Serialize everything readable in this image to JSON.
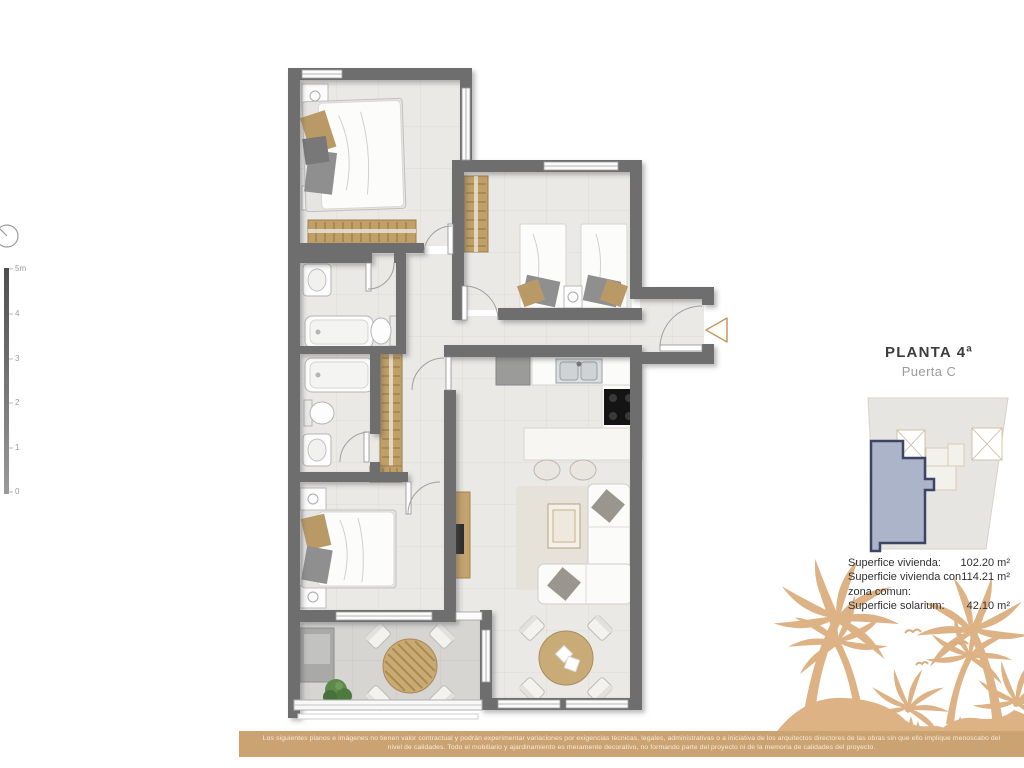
{
  "header": {
    "title": "PLANTA 4ª",
    "subtitle": "Puerta C"
  },
  "surfaces": {
    "row1_label": "Superfice vivienda:",
    "row1_value": "102.20 m²",
    "row2_label_line1": "Superficie vivienda con",
    "row2_label_line2": "zona comun:",
    "row2_value": "114.21 m²",
    "row3_label": "Superficie solarium:",
    "row3_value": "42.10 m²"
  },
  "scale_bar": {
    "ticks": [
      "5m",
      "4",
      "3",
      "2",
      "1",
      "0"
    ]
  },
  "disclaimer": {
    "text": "Los siguientes planos e imágenes no tienen valor contractual y podrán experimentar variaciones por exigencias técnicas, legales, administrativas o a iniciativa de los arquitectos directores de las obras sin que ello implique menoscabo del nivel de calidades. Todo el mobiliario y ajardinamiento es meramente decorativo, no formando parte del proyecto ni de la memoria de calidades del proyecto."
  },
  "colors": {
    "accent_tan_band": "#cba271",
    "palm_tan": "#ddb285",
    "wall_gray": "#6e6e6e",
    "unit_highlight_fill": "#a8b1c7",
    "unit_highlight_border": "#3c4566"
  }
}
